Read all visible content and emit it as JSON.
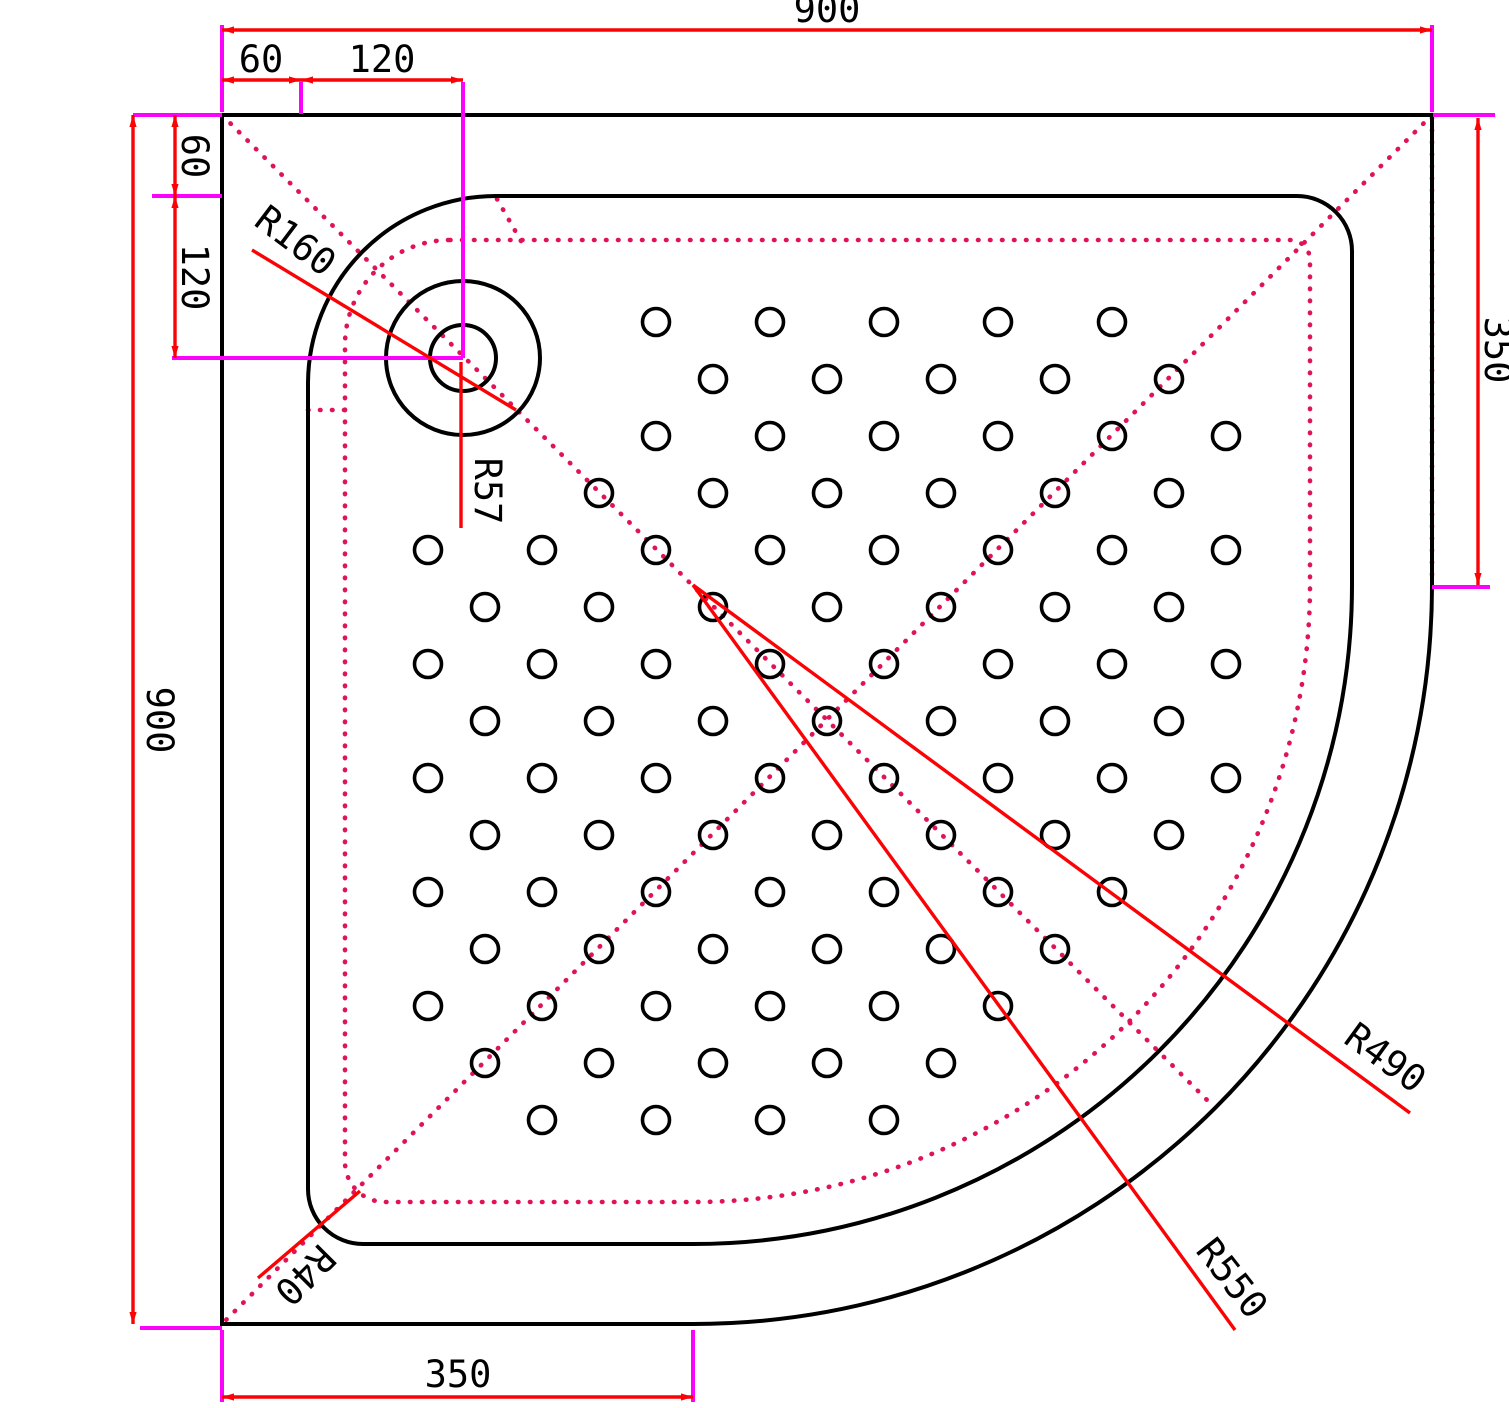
{
  "title": "Quadrant shower tray technical drawing 900x900",
  "colors": {
    "background": "#ffffff",
    "outline_black": "#000000",
    "dimension_red": "#fb0205",
    "extension_magenta": "#fb02fb",
    "dotted_crimson": "#e01356"
  },
  "dimensions": {
    "top_width": "900",
    "top_offset_a": "60",
    "top_offset_b": "120",
    "left_height": "900",
    "left_offset_a": "60",
    "left_offset_b": "120",
    "right_depth": "350",
    "bottom_depth": "350"
  },
  "radius_labels": {
    "inner_corner_large": "R160",
    "drain": "R57",
    "quadrant_inner": "R490",
    "quadrant_outer": "R550",
    "small_corner": "R40"
  },
  "dot_pattern": {
    "x0": 428,
    "y0": 322,
    "step": 57,
    "cols": 15,
    "rows": 15,
    "radius": 13.5,
    "drain_center_x": 463,
    "drain_center_y": 358,
    "drain_clearance": 185,
    "arc_center_x": 693,
    "arc_center_y": 585,
    "arc_max_dist": 588
  }
}
